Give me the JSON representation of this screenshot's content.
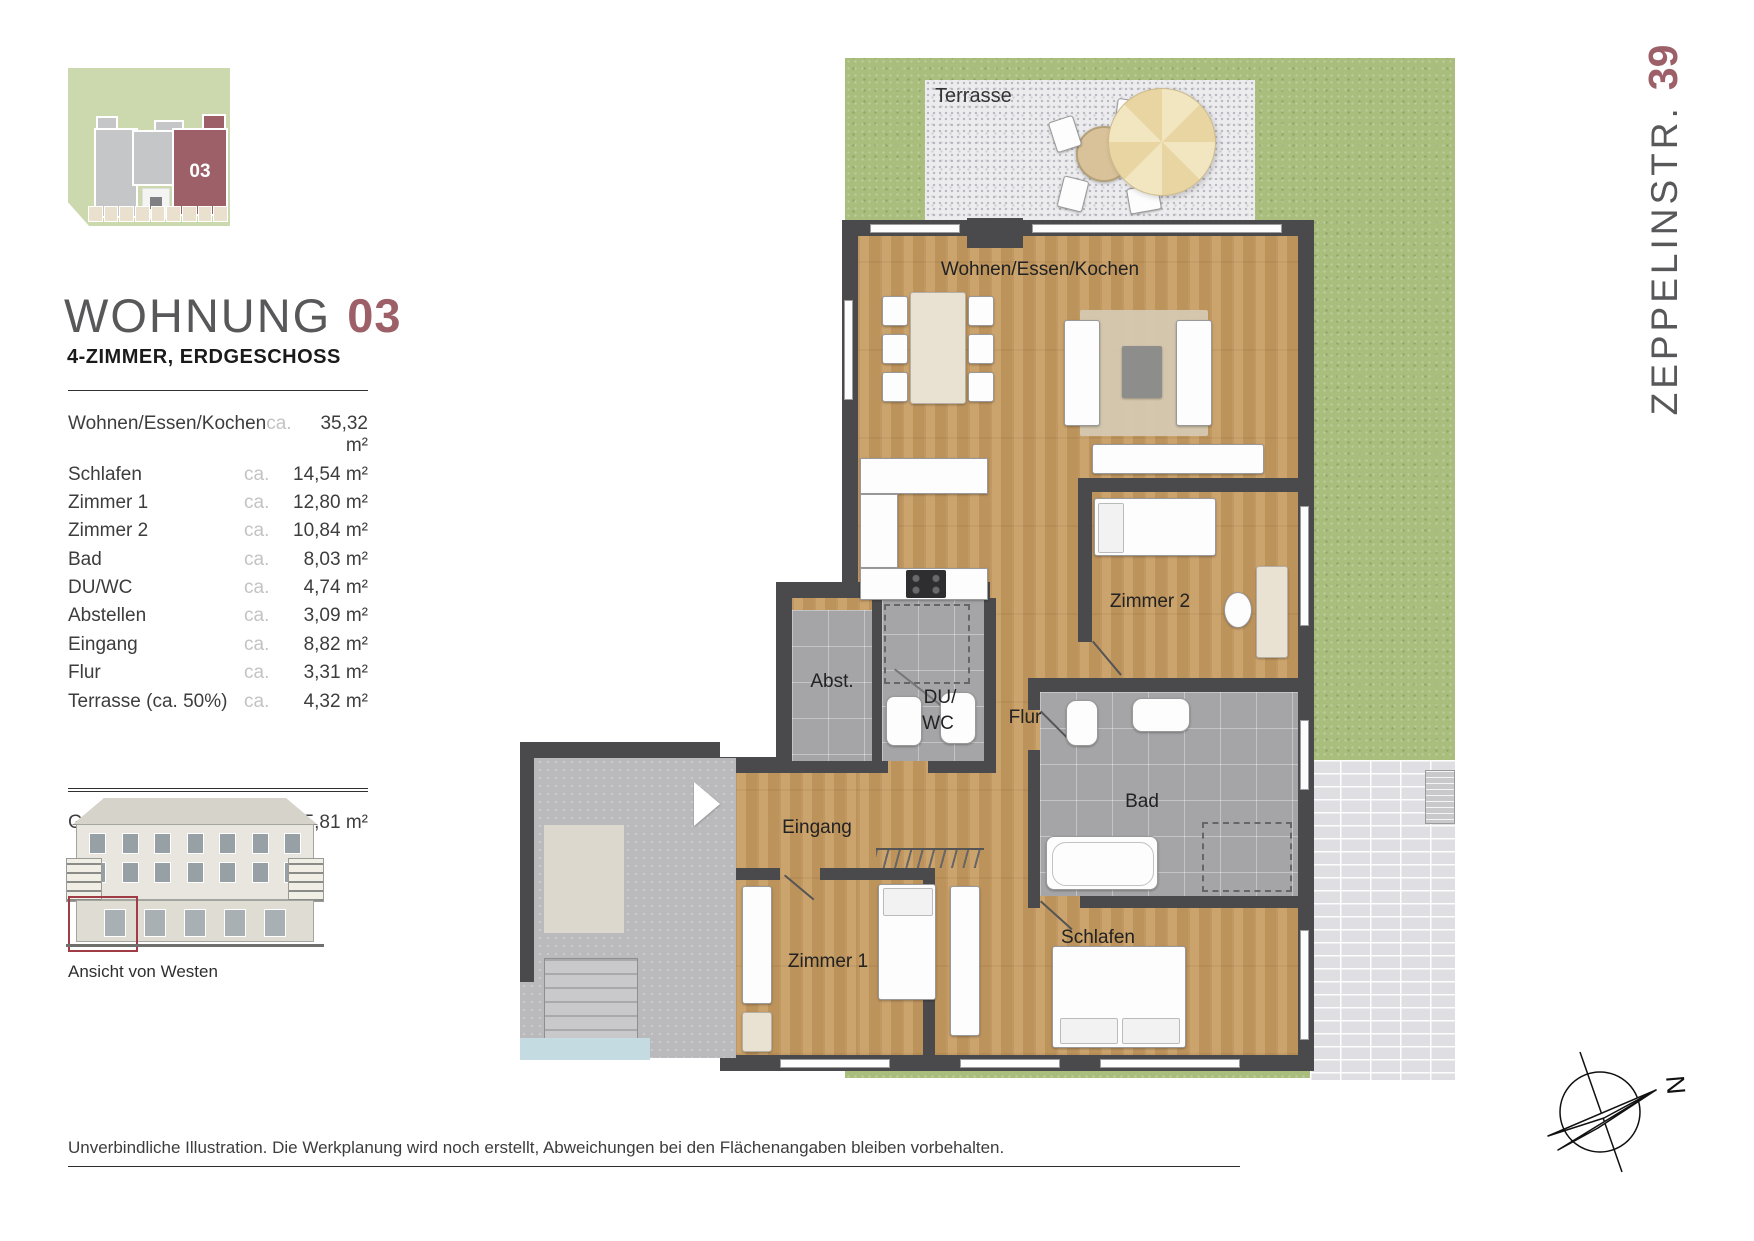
{
  "brand": {
    "street_name": "ZEPPELINSTR.",
    "street_number": "39"
  },
  "header": {
    "title_main": "WOHNUNG",
    "title_number": "03",
    "subtitle": "4-ZIMMER, ERDGESCHOSS"
  },
  "site_plan": {
    "unit_label": "03"
  },
  "area_table": {
    "rows": [
      {
        "name": "Wohnen/Essen/Kochen",
        "approx": "ca.",
        "value": "35,32 m²"
      },
      {
        "name": "Schlafen",
        "approx": "ca.",
        "value": "14,54 m²"
      },
      {
        "name": "Zimmer 1",
        "approx": "ca.",
        "value": "12,80 m²"
      },
      {
        "name": "Zimmer 2",
        "approx": "ca.",
        "value": "10,84 m²"
      },
      {
        "name": "Bad",
        "approx": "ca.",
        "value": "8,03 m²"
      },
      {
        "name": "DU/WC",
        "approx": "ca.",
        "value": "4,74 m²"
      },
      {
        "name": "Abstellen",
        "approx": "ca.",
        "value": "3,09 m²"
      },
      {
        "name": "Eingang",
        "approx": "ca.",
        "value": "8,82 m²"
      },
      {
        "name": "Flur",
        "approx": "ca.",
        "value": "3,31 m²"
      },
      {
        "name": "Terrasse (ca. 50%)",
        "approx": "ca.",
        "value": "4,32 m²"
      }
    ],
    "total_name": "Gesamt",
    "total_value": "ca. 105,81 m²"
  },
  "elevation": {
    "caption": "Ansicht von Westen"
  },
  "floor_plan": {
    "labels": {
      "terrasse": "Terrasse",
      "wohnen": "Wohnen/Essen/Kochen",
      "zimmer2": "Zimmer 2",
      "flur": "Flur",
      "abst": "Abst.",
      "du": "DU/",
      "wc": "WC",
      "bad": "Bad",
      "eingang": "Eingang",
      "zimmer1": "Zimmer 1",
      "schlafen": "Schlafen"
    }
  },
  "compass": {
    "north": "N"
  },
  "footer": {
    "disclaimer": "Unverbindliche Illustration. Die Werkplanung wird noch erstellt, Abweichungen bei den Flächenangaben bleiben vorbehalten."
  },
  "colors": {
    "accent": "#9d6069",
    "wall": "#4a4a4c",
    "wood": "#c79b61",
    "grass": "#a9bd7d"
  }
}
